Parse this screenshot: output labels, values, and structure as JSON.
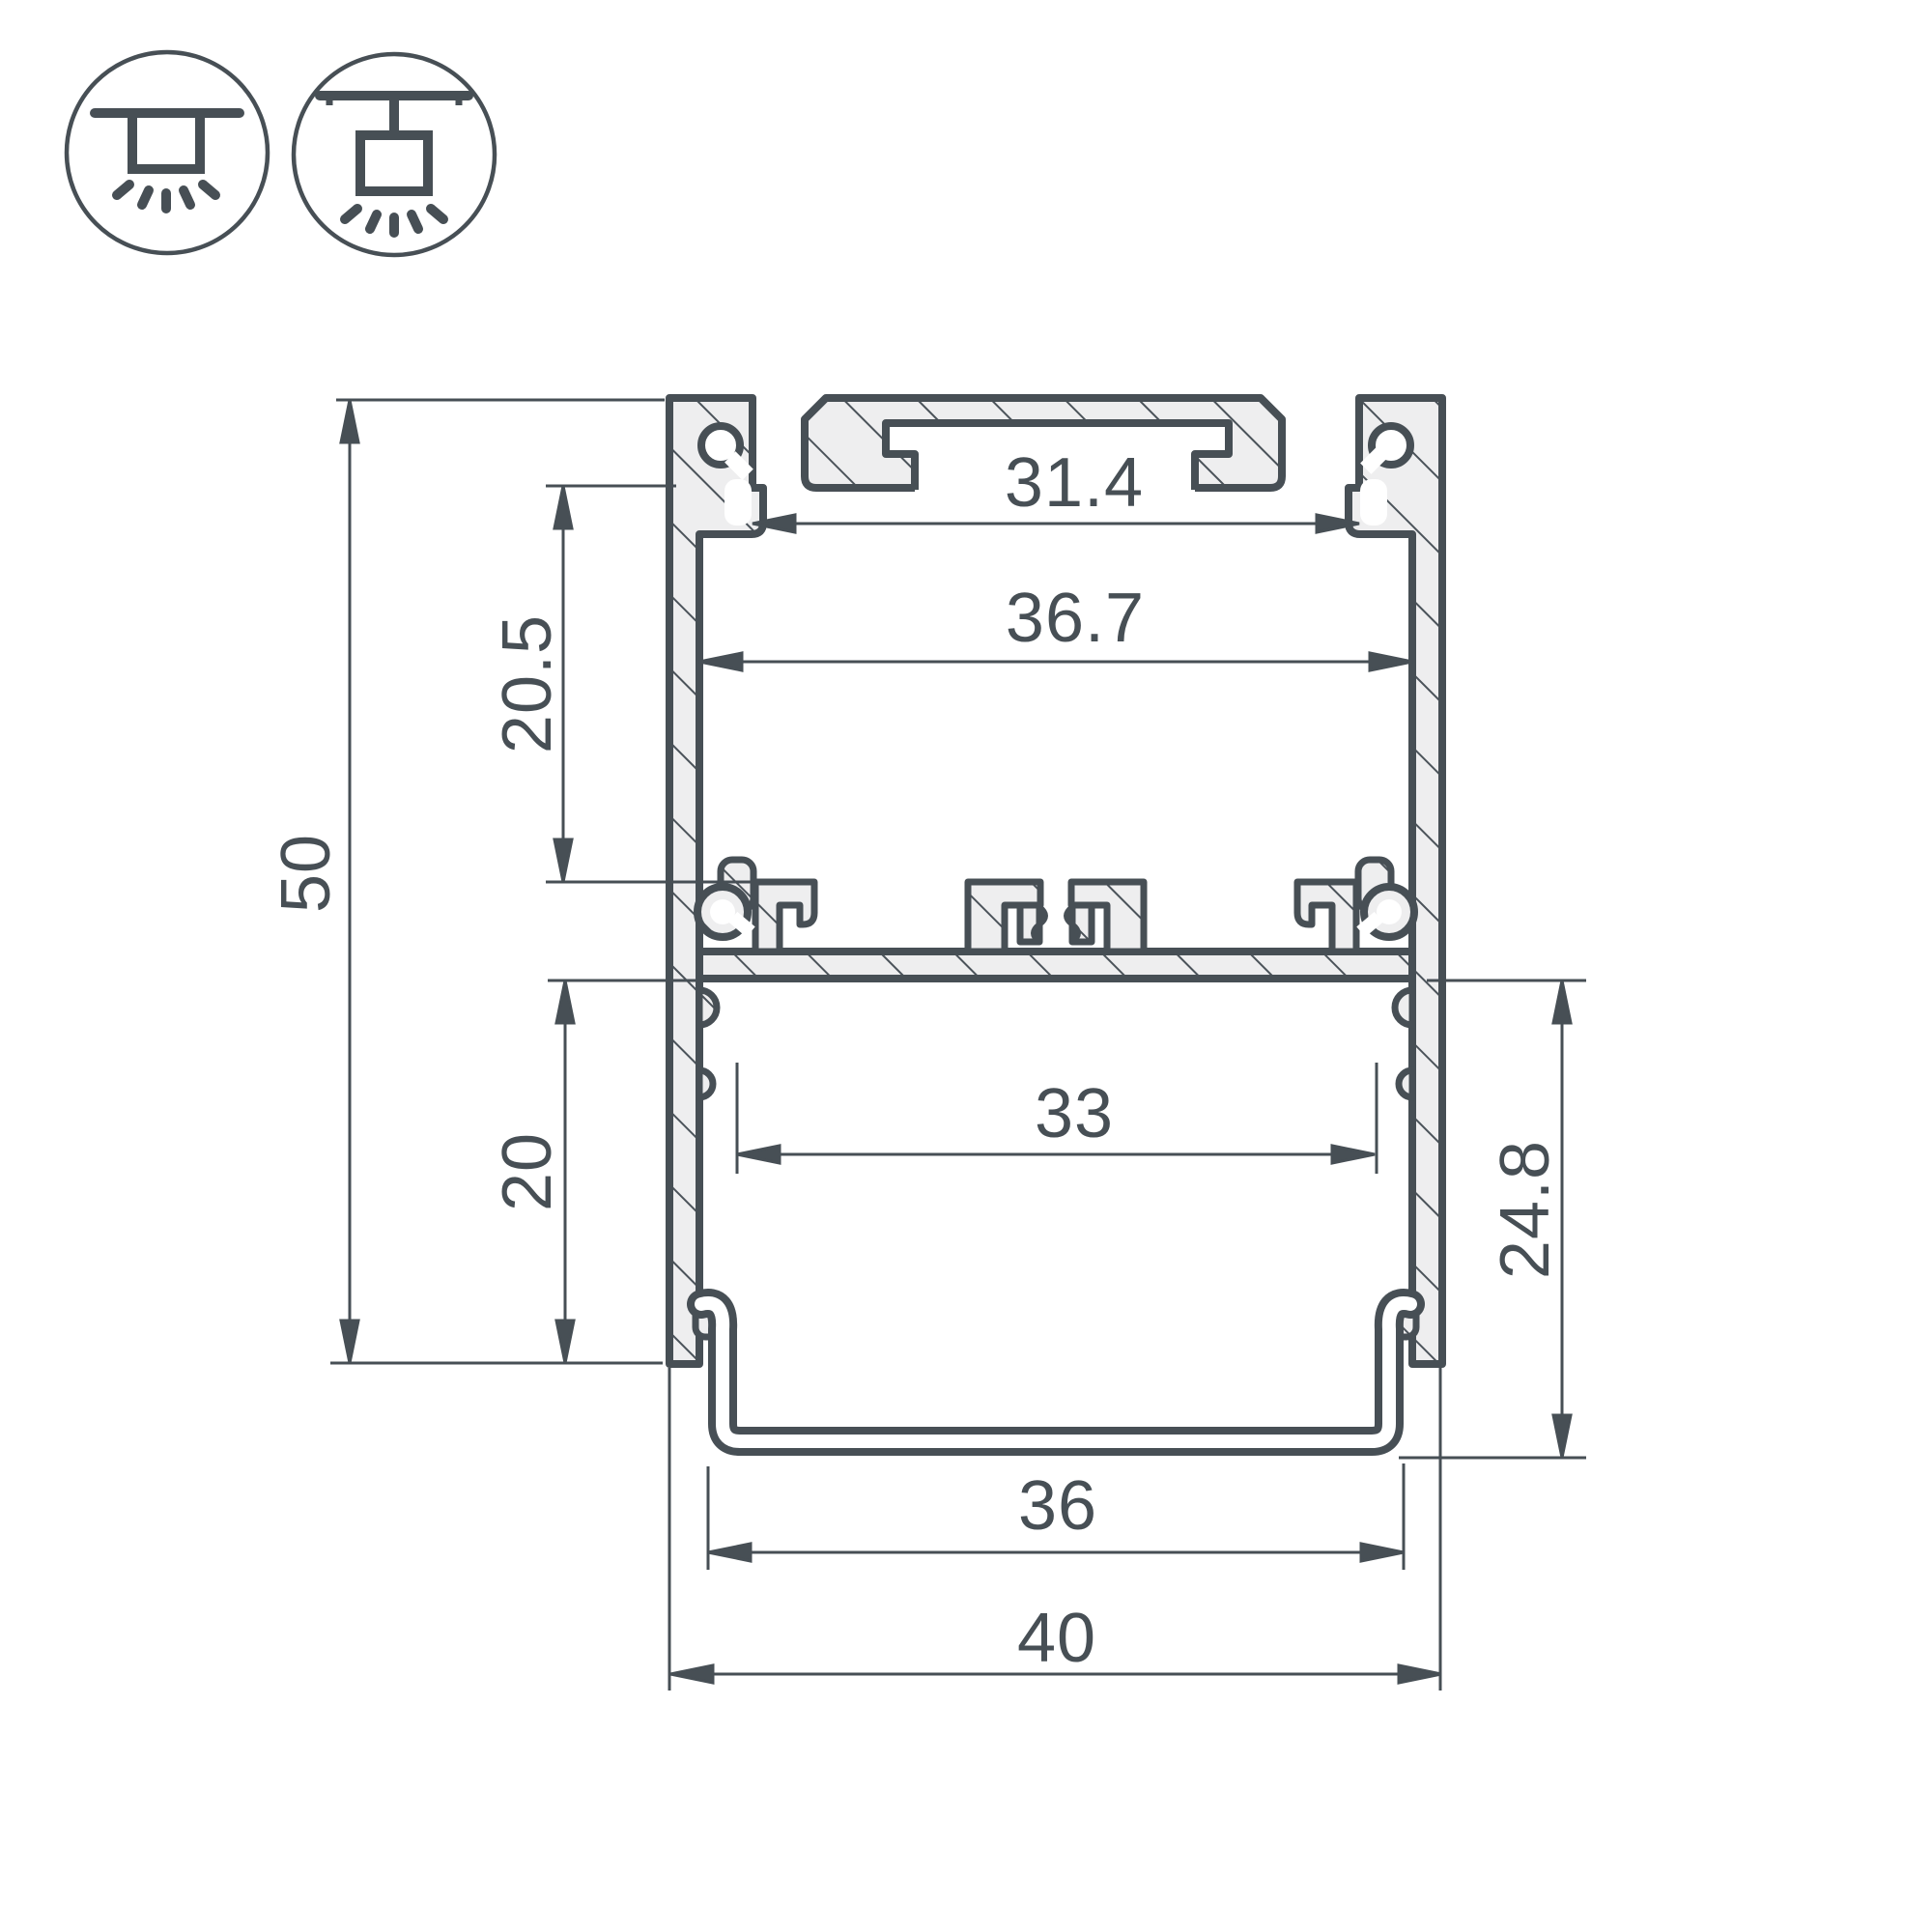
{
  "title": "LED aluminium profile cross-section technical drawing",
  "colors": {
    "line": "#474f55",
    "aluminum_fill": "#eeeeef",
    "background": "#ffffff"
  },
  "mount_icons": [
    {
      "name": "surface-ceiling-mount"
    },
    {
      "name": "pendant-ceiling-mount"
    }
  ],
  "dimensions": {
    "top_slot_width": "31.4",
    "inner_width": "36.7",
    "upper_channel_depth": "20.5",
    "overall_height": "50",
    "lower_channel_depth": "20",
    "diffuser_inner_width": "33",
    "diffuser_section_height": "24.8",
    "diffuser_outer_width": "36",
    "overall_width": "40"
  }
}
